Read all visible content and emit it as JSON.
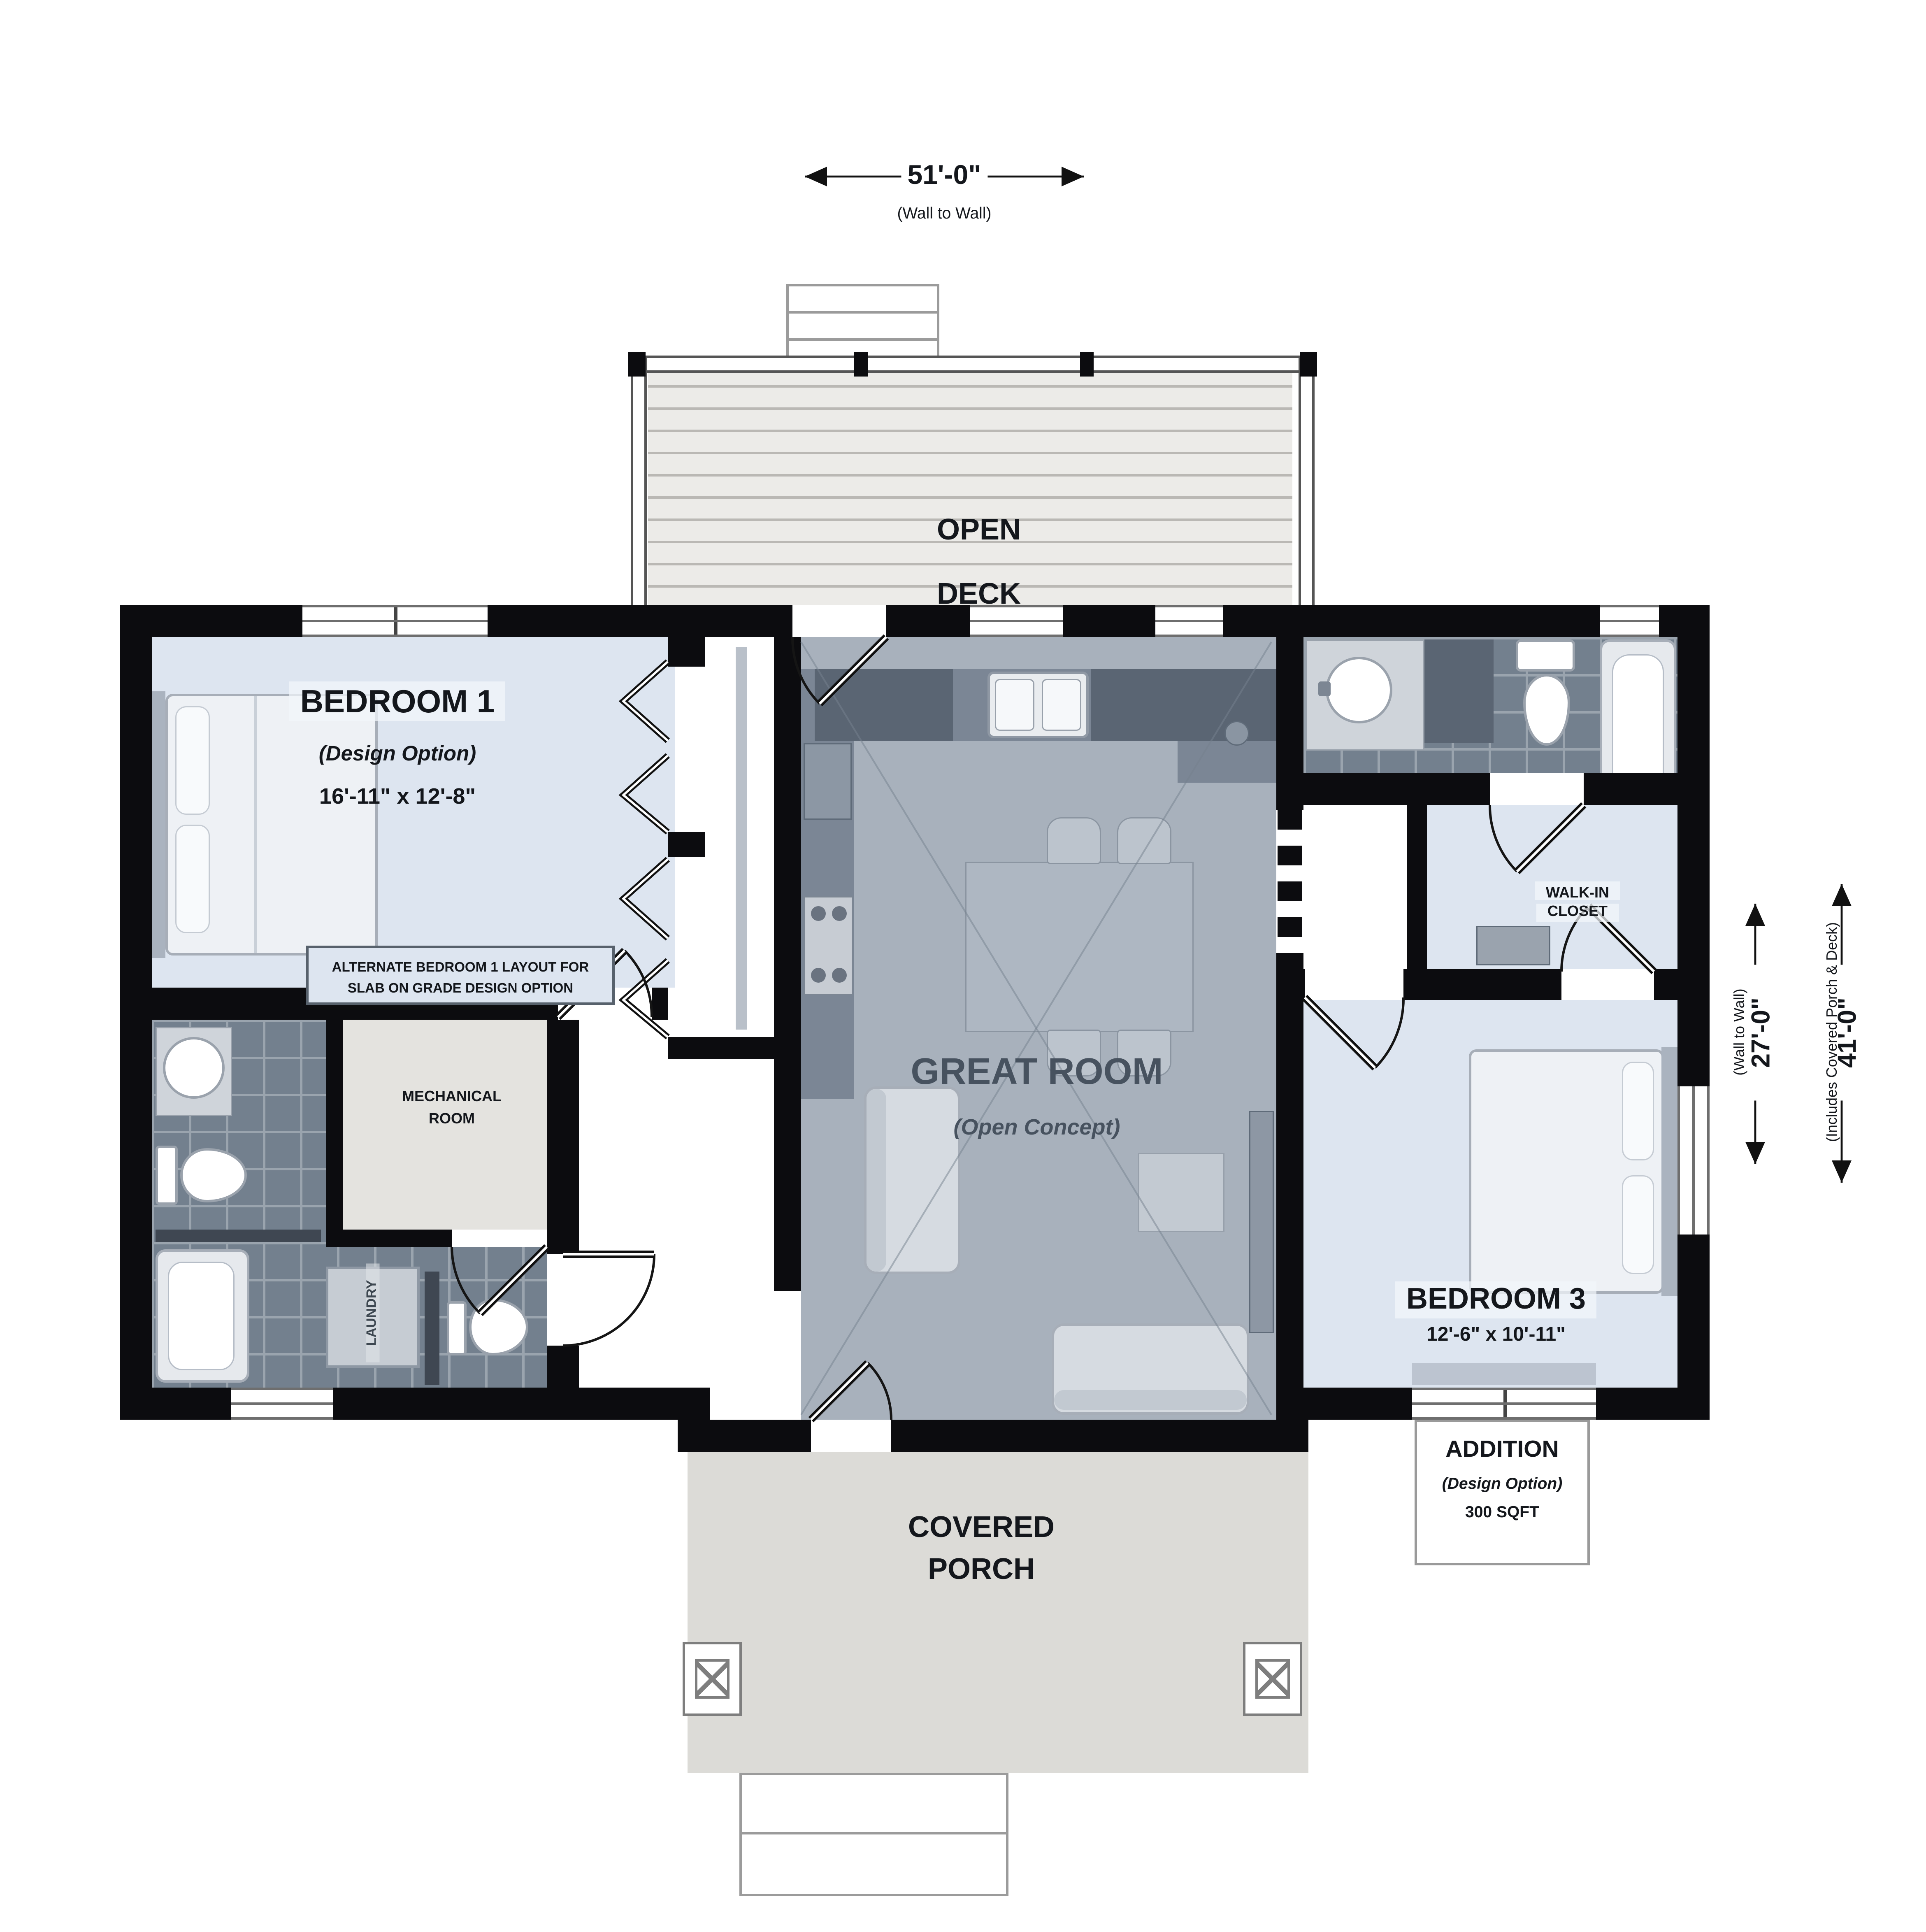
{
  "colors": {
    "wall": "#0c0c0f",
    "bedroom_floor": "#dde5f0",
    "great_room_floor": "#a8b1bc",
    "tile_floor": "#73808e",
    "tile_grout": "#9aa4ae",
    "concrete": "#e4e3df",
    "deck_plank": "#ecebe8",
    "deck_line": "#bab8b4",
    "porch": "#dcdbd7",
    "label_dark": "#14171c",
    "great_room_label": "#47525f",
    "fixture_light": "#eef1f5",
    "fixture_border": "#a7aeb8",
    "counter": "#7b8695",
    "cabinet_dark": "#5a6573"
  },
  "dimensions": {
    "width_total": {
      "value": "51'-0\"",
      "note": "(Wall to Wall)"
    },
    "depth_wall": {
      "value": "27'-0\"",
      "note": "(Wall to Wall)"
    },
    "depth_total": {
      "value": "41'-0\"",
      "note": "(Includes Covered Porch & Deck)"
    }
  },
  "rooms": {
    "open_deck": {
      "line1": "OPEN",
      "line2": "DECK"
    },
    "bedroom1": {
      "name": "BEDROOM 1",
      "option": "(Design Option)",
      "size": "16'-11\" x 12'-8\""
    },
    "bedroom1_note": {
      "line1": "ALTERNATE BEDROOM 1 LAYOUT FOR",
      "line2": "SLAB ON GRADE DESIGN OPTION"
    },
    "mechanical": {
      "line1": "MECHANICAL",
      "line2": "ROOM"
    },
    "laundry": {
      "label": "LAUNDRY"
    },
    "great_room": {
      "name": "GREAT ROOM",
      "option": "(Open Concept)"
    },
    "walk_in_closet": {
      "line1": "WALK-IN",
      "line2": "CLOSET"
    },
    "bedroom3": {
      "name": "BEDROOM 3",
      "size": "12'-6\" x 10'-11\""
    },
    "addition": {
      "name": "ADDITION",
      "option": "(Design Option)",
      "size": "300 SQFT"
    },
    "covered_porch": {
      "line1": "COVERED",
      "line2": "PORCH"
    }
  }
}
